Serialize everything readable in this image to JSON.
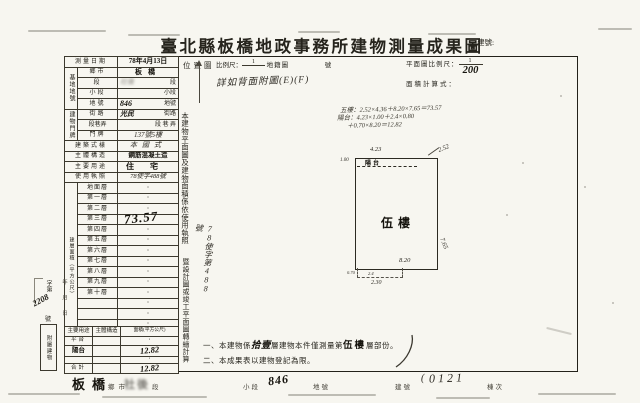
{
  "title": "臺北縣板橋地政事務所建物測量成果圖",
  "building_no_label": "建號:",
  "survey": {
    "date_label": "測量日期",
    "date": "78年4月13日"
  },
  "site": {
    "group": "基地地號",
    "rows": [
      {
        "label": "鄉市",
        "hand": "板橋",
        "suffix": ""
      },
      {
        "label": "段",
        "hand": "社後",
        "suffix": "段"
      },
      {
        "label": "小段",
        "hand": "",
        "suffix": "小段"
      },
      {
        "label": "地號",
        "hand": "846",
        "suffix": "地號"
      }
    ]
  },
  "door": {
    "group": "建物門牌",
    "rows": [
      {
        "label": "街路",
        "hand": "光民",
        "suffix": "街路"
      },
      {
        "label": "段巷弄",
        "hand": "",
        "suffix": "段 巷 弄"
      },
      {
        "label": "門牌",
        "hand": "137號5樓",
        "suffix": ""
      }
    ]
  },
  "style_row": {
    "label": "建築式樣",
    "value": "本國式"
  },
  "structure_row": {
    "label": "主體構造",
    "value": "鋼筋混凝土造"
  },
  "use_row": {
    "label": "主要用途",
    "value": "住宅"
  },
  "license_row": {
    "label": "使用執照",
    "value": "78使字488號"
  },
  "floors": {
    "group": "建層面積（平方公尺）",
    "rows": [
      {
        "label": "地面層",
        "value": "·"
      },
      {
        "label": "第一層",
        "value": "·"
      },
      {
        "label": "第二層",
        "value": "·"
      },
      {
        "label": "第三層",
        "value": "·"
      },
      {
        "label": "第四層",
        "value": "·"
      },
      {
        "label": "第五層",
        "value": "·"
      },
      {
        "label": "第六層",
        "value": "·"
      },
      {
        "label": "第七層",
        "value": "·"
      },
      {
        "label": "第八層",
        "value": "·"
      },
      {
        "label": "第九層",
        "value": "·"
      },
      {
        "label": "第十層",
        "value": "·"
      },
      {
        "label": "",
        "value": "·"
      },
      {
        "label": "",
        "value": "·"
      },
      {
        "label": "",
        "value": "·"
      },
      {
        "label": "地下層",
        "value": "·"
      },
      {
        "label": "騎樓",
        "value": "·"
      }
    ],
    "fifth_value": "73.57",
    "total_label": "合計",
    "total_value": "73.57"
  },
  "annex": {
    "group": "附屬建物",
    "headers": [
      "主要用途",
      "主體構造",
      "面積(平方公尺)"
    ],
    "rows": [
      {
        "use": "平台",
        "structure": "",
        "area": "·"
      },
      {
        "use": "陽台",
        "structure": "",
        "area": "12.82"
      },
      {
        "use": "",
        "structure": "",
        "area": "·"
      },
      {
        "use": "合計",
        "structure": "",
        "area": "12.82"
      }
    ]
  },
  "margin_stamp": {
    "zi": "字第",
    "number": "2208",
    "hao": "號",
    "date_col": "年 月 日"
  },
  "vertical_note": {
    "part1": "本建物平面圖及建物面積係依使用執照",
    "hand": "78使字第488號",
    "part2": "暨設計圖或竣工平面圖轉繪計算"
  },
  "band": {
    "location": "位置圖",
    "scale_label": "比例尺：",
    "scale_num": "1",
    "cadastral": "地籍圖",
    "no": "號",
    "plan_scale_label": "平面圖比例尺：",
    "plan_scale_num": "1",
    "plan_scale_hand": "200",
    "calc_label": "面積計算式：",
    "ref_hand": "詳如背面附圖(E)(F)"
  },
  "calc": {
    "line1": "五樓：2.52×4.36＋8.20×7.65＝73.57",
    "line2": "陽台：4.23×1.00＋2.4×0.80",
    "line3": "＋0.70×8.20＝12.82"
  },
  "plan": {
    "room": "伍樓",
    "balcony": "陽台",
    "dim_top": "4.23",
    "dim_top_right": "2.52",
    "dim_right": "7.65",
    "dim_bottom": "8.20",
    "dim_left": "1.00",
    "dim_notch_a": "0.70",
    "dim_notch_b": "2.4",
    "dim_bottom_left": "2.30"
  },
  "notes": {
    "n1a": "一、本建物係",
    "n1_hand": "拾壹",
    "n1b": "層建物本件僅測量第",
    "n1_stamp": "伍樓",
    "n1c": "層部份。",
    "n2": "二、本成果表以建物登記為限。"
  },
  "footer": {
    "city": "板橋",
    "city_label": "鄉市",
    "section": "社後",
    "section_label": "段",
    "subsection_label": "小段",
    "parcel": "846",
    "parcel_label": "地號",
    "building_label": "建號",
    "building_no": "0121",
    "unit_label": "棟次"
  }
}
